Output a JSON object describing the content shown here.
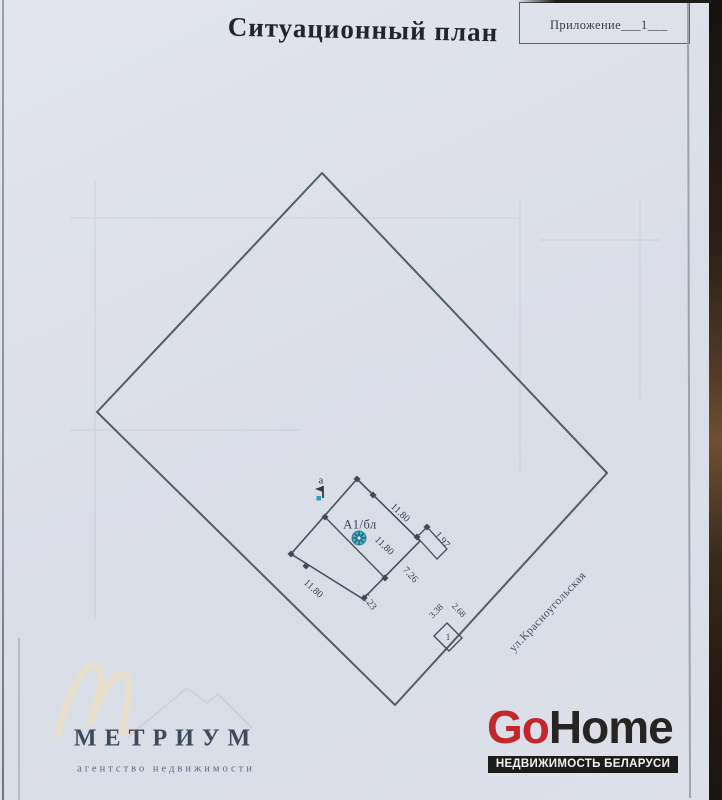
{
  "document": {
    "title": "Ситуационный план",
    "annex": "Приложение___1___"
  },
  "plan": {
    "street": "ул.Красноугольская",
    "house_label": "А1/бл",
    "point_label": "а",
    "shed_label": "1",
    "dims": {
      "outer_top": "11.80",
      "inner": "11.80",
      "porch": "1.97",
      "right_lower": "7.26",
      "bottom": "5.23",
      "outer_left": "11.80",
      "shed_left": "3.38",
      "shed_right": "2.68"
    }
  },
  "branding": {
    "metrium": {
      "name": "МЕТРИУМ",
      "tagline": "агентство недвижимости"
    },
    "gohome": {
      "prefix": "Go",
      "suffix": "Home",
      "tagline": "НЕДВИЖИМОСТЬ БЕЛАРУСИ"
    }
  },
  "colors": {
    "paper": "#dde0e9",
    "plot_outline": "#50605e",
    "building_line": "#46505c",
    "marker_teal": "#4ab2c9",
    "gohome_red": "#c3272b",
    "gohome_dark": "#272524",
    "photo_edge_brown": "#553b27"
  }
}
